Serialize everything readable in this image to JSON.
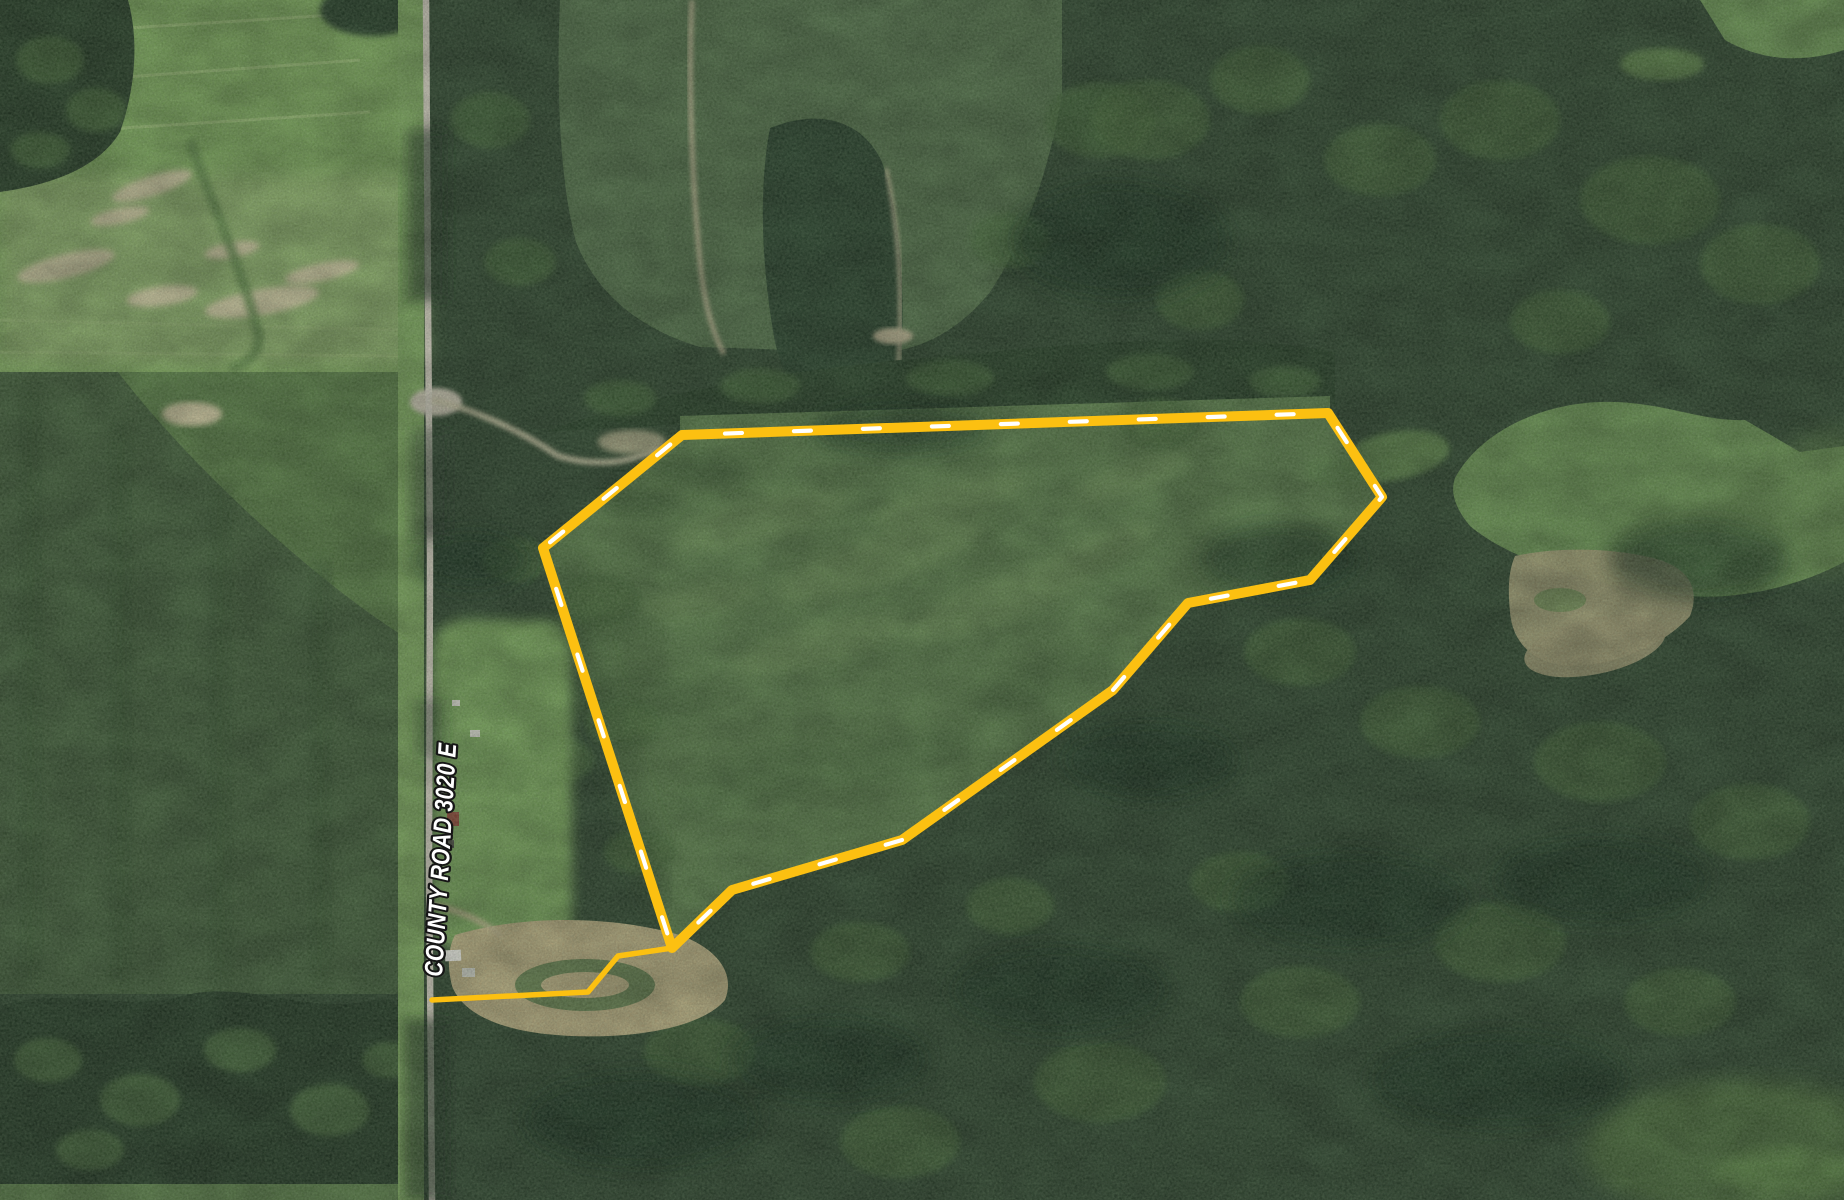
{
  "map": {
    "road": {
      "label": "COUNTY ROAD 3020 E",
      "label_color": "#FFFFFF",
      "label_outline_color": "#161616"
    },
    "boundary": {
      "color": "#FCC011",
      "dash_color": "#FFFFFF",
      "polygon_points": "682,435 1328,413 1382,497 1310,580 1188,603 1113,690 902,840 732,890 672,948 543,548",
      "spur_points": "672,948 618,956 588,992 432,1000"
    }
  }
}
